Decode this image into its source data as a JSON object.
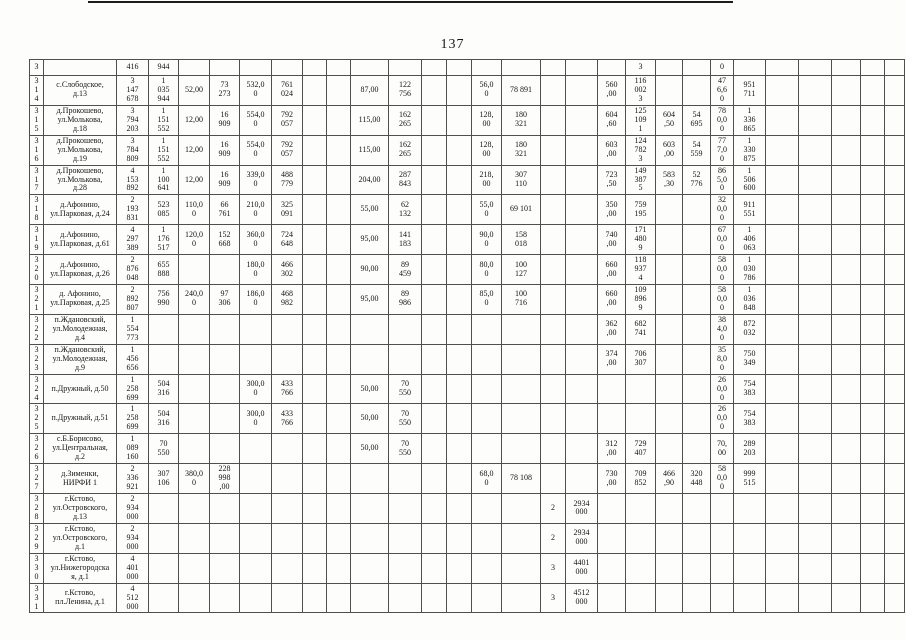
{
  "page": {
    "number": "137"
  },
  "table": {
    "rows": [
      {
        "num": "3",
        "address": "",
        "cells": [
          "416",
          "944",
          "",
          "",
          "",
          "",
          "",
          "",
          "",
          "",
          "",
          "",
          "",
          "",
          "",
          "",
          "",
          "3",
          "",
          "",
          "0",
          "",
          "",
          "",
          "",
          "",
          ""
        ]
      },
      {
        "num": "3\n1\n4",
        "address": "с.Слободское,\nд.13",
        "cells": [
          "3\n147\n678",
          "1\n035\n944",
          "52,00",
          "73\n273",
          "532,0\n0",
          "761\n024",
          "",
          "",
          "87,00",
          "122\n756",
          "",
          "",
          "56,0\n0",
          "78 891",
          "",
          "",
          "560\n,00",
          "116\n002\n3",
          "",
          "",
          "47\n6,6\n0",
          "951\n711",
          "",
          "",
          "",
          "",
          ""
        ]
      },
      {
        "num": "3\n1\n5",
        "address": "д.Прокошево,\nул.Молькова,\nд.18",
        "cells": [
          "3\n794\n203",
          "1\n151\n552",
          "12,00",
          "16\n909",
          "554,0\n0",
          "792\n057",
          "",
          "",
          "115,00",
          "162\n265",
          "",
          "",
          "128,\n00",
          "180\n321",
          "",
          "",
          "604\n,60",
          "125\n109\n1",
          "604\n,50",
          "54\n695",
          "78\n0,0\n0",
          "1\n336\n865",
          "",
          "",
          "",
          "",
          ""
        ]
      },
      {
        "num": "3\n1\n6",
        "address": "д.Прокошево,\nул.Молькова,\nд.19",
        "cells": [
          "3\n784\n809",
          "1\n151\n552",
          "12,00",
          "16\n909",
          "554,0\n0",
          "792\n057",
          "",
          "",
          "115,00",
          "162\n265",
          "",
          "",
          "128,\n00",
          "180\n321",
          "",
          "",
          "603\n,00",
          "124\n782\n3",
          "603\n,00",
          "54\n559",
          "77\n7,0\n0",
          "1\n330\n875",
          "",
          "",
          "",
          "",
          ""
        ]
      },
      {
        "num": "3\n1\n7",
        "address": "д.Прокошево,\nул.Молькова,\nд.28",
        "cells": [
          "4\n153\n892",
          "1\n100\n641",
          "12,00",
          "16\n909",
          "339,0\n0",
          "488\n779",
          "",
          "",
          "204,00",
          "287\n843",
          "",
          "",
          "218,\n00",
          "307\n110",
          "",
          "",
          "723\n,50",
          "149\n387\n5",
          "583\n,30",
          "52\n776",
          "86\n5,0\n0",
          "1\n506\n600",
          "",
          "",
          "",
          "",
          ""
        ]
      },
      {
        "num": "3\n1\n8",
        "address": "д.Афонино,\nул.Парковая, д.24",
        "cells": [
          "2\n193\n831",
          "523\n085",
          "110,0\n0",
          "66\n761",
          "210,0\n0",
          "325\n091",
          "",
          "",
          "55,00",
          "62\n132",
          "",
          "",
          "55,0\n0",
          "69 101",
          "",
          "",
          "350\n,00",
          "759\n195",
          "",
          "",
          "32\n0,0\n0",
          "911\n551",
          "",
          "",
          "",
          "",
          ""
        ]
      },
      {
        "num": "3\n1\n9",
        "address": "д.Афонино,\nул.Парковая, д.61",
        "cells": [
          "4\n297\n389",
          "1\n176\n517",
          "120,0\n0",
          "152\n668",
          "360,0\n0",
          "724\n648",
          "",
          "",
          "95,00",
          "141\n183",
          "",
          "",
          "90,0\n0",
          "158\n018",
          "",
          "",
          "740\n,00",
          "171\n480\n9",
          "",
          "",
          "67\n0,0\n0",
          "1\n406\n063",
          "",
          "",
          "",
          "",
          ""
        ]
      },
      {
        "num": "3\n2\n0",
        "address": "д.Афонино,\nул.Парковая, д.26",
        "cells": [
          "2\n876\n048",
          "655\n888",
          "",
          "",
          "180,0\n0",
          "466\n302",
          "",
          "",
          "90,00",
          "89\n459",
          "",
          "",
          "80,0\n0",
          "100\n127",
          "",
          "",
          "660\n,00",
          "118\n937\n4",
          "",
          "",
          "58\n0,0\n0",
          "1\n030\n786",
          "",
          "",
          "",
          "",
          ""
        ]
      },
      {
        "num": "3\n2\n1",
        "address": "д. Афонино,\nул.Парковая, д.25",
        "cells": [
          "2\n892\n807",
          "756\n990",
          "240,0\n0",
          "97\n306",
          "186,0\n0",
          "468\n982",
          "",
          "",
          "95,00",
          "89\n986",
          "",
          "",
          "85,0\n0",
          "100\n716",
          "",
          "",
          "660\n,00",
          "109\n896\n9",
          "",
          "",
          "58\n0,0\n0",
          "1\n036\n848",
          "",
          "",
          "",
          "",
          ""
        ]
      },
      {
        "num": "3\n2\n2",
        "address": "п.Ждановский,\nул.Молодежная,\nд.4",
        "cells": [
          "1\n554\n773",
          "",
          "",
          "",
          "",
          "",
          "",
          "",
          "",
          "",
          "",
          "",
          "",
          "",
          "",
          "",
          "362\n,00",
          "682\n741",
          "",
          "",
          "38\n4,0\n0",
          "872\n032",
          "",
          "",
          "",
          "",
          ""
        ]
      },
      {
        "num": "3\n2\n3",
        "address": "п.Ждановский,\nул.Молодежная,\nд.9",
        "cells": [
          "1\n456\n656",
          "",
          "",
          "",
          "",
          "",
          "",
          "",
          "",
          "",
          "",
          "",
          "",
          "",
          "",
          "",
          "374\n,00",
          "706\n307",
          "",
          "",
          "35\n8,0\n0",
          "750\n349",
          "",
          "",
          "",
          "",
          ""
        ]
      },
      {
        "num": "3\n2\n4",
        "address": "п.Дружный, д.50",
        "cells": [
          "1\n258\n699",
          "504\n316",
          "",
          "",
          "300,0\n0",
          "433\n766",
          "",
          "",
          "50,00",
          "70\n550",
          "",
          "",
          "",
          "",
          "",
          "",
          "",
          "",
          "",
          "",
          "26\n0,0\n0",
          "754\n383",
          "",
          "",
          "",
          "",
          ""
        ]
      },
      {
        "num": "3\n2\n5",
        "address": "п.Дружный, д.51",
        "cells": [
          "1\n258\n699",
          "504\n316",
          "",
          "",
          "300,0\n0",
          "433\n766",
          "",
          "",
          "50,00",
          "70\n550",
          "",
          "",
          "",
          "",
          "",
          "",
          "",
          "",
          "",
          "",
          "26\n0,0\n0",
          "754\n383",
          "",
          "",
          "",
          "",
          ""
        ]
      },
      {
        "num": "3\n2\n6",
        "address": "с.Б.Борисово,\nул.Центральная,\nд.2",
        "cells": [
          "1\n089\n160",
          "70\n550",
          "",
          "",
          "",
          "",
          "",
          "",
          "50,00",
          "70\n550",
          "",
          "",
          "",
          "",
          "",
          "",
          "312\n,00",
          "729\n407",
          "",
          "",
          "70,\n00",
          "289\n203",
          "",
          "",
          "",
          "",
          ""
        ]
      },
      {
        "num": "3\n2\n7",
        "address": "д.Зименки,\nНИРФИ 1",
        "cells": [
          "2\n336\n921",
          "307\n106",
          "380,0\n0",
          "228\n998\n,00",
          "",
          "",
          "",
          "",
          "",
          "",
          "",
          "",
          "68,0\n0",
          "78 108",
          "",
          "",
          "730\n,00",
          "709\n852",
          "466\n,90",
          "320\n448",
          "58\n0,0\n0",
          "999\n515",
          "",
          "",
          "",
          "",
          ""
        ]
      },
      {
        "num": "3\n2\n8",
        "address": "г.Кстово,\nул.Островского,\nд.13",
        "cells": [
          "2\n934\n000",
          "",
          "",
          "",
          "",
          "",
          "",
          "",
          "",
          "",
          "",
          "",
          "",
          "",
          "2",
          "2934\n000",
          "",
          "",
          "",
          "",
          "",
          "",
          "",
          "",
          "",
          "",
          ""
        ]
      },
      {
        "num": "3\n2\n9",
        "address": "г.Кстово,\nул.Островского,\nд.1",
        "cells": [
          "2\n934\n000",
          "",
          "",
          "",
          "",
          "",
          "",
          "",
          "",
          "",
          "",
          "",
          "",
          "",
          "2",
          "2934\n000",
          "",
          "",
          "",
          "",
          "",
          "",
          "",
          "",
          "",
          "",
          ""
        ]
      },
      {
        "num": "3\n3\n0",
        "address": "г.Кстово,\nул.Нижегородска\nя, д.1",
        "cells": [
          "4\n401\n000",
          "",
          "",
          "",
          "",
          "",
          "",
          "",
          "",
          "",
          "",
          "",
          "",
          "",
          "3",
          "4401\n000",
          "",
          "",
          "",
          "",
          "",
          "",
          "",
          "",
          "",
          "",
          ""
        ]
      },
      {
        "num": "3\n3\n1",
        "address": "г.Кстово,\nпл.Ленина, д.1",
        "cells": [
          "4\n512\n000",
          "",
          "",
          "",
          "",
          "",
          "",
          "",
          "",
          "",
          "",
          "",
          "",
          "",
          "3",
          "4512\n000",
          "",
          "",
          "",
          "",
          "",
          "",
          "",
          "",
          "",
          "",
          ""
        ]
      }
    ]
  }
}
